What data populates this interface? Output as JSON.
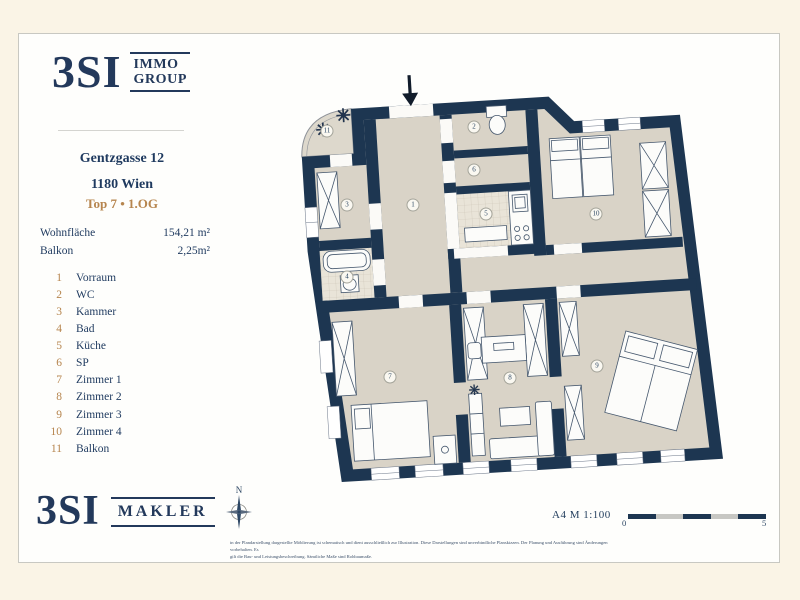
{
  "colors": {
    "brand_navy": "#23395b",
    "accent_tan": "#b6854e",
    "wall_navy": "#1d3651",
    "floor_beige": "#d9d3c7",
    "paper_cream": "#faf4e6"
  },
  "sidebar": {
    "logo_top": {
      "mark": "3SI",
      "name_line1": "IMMO",
      "name_line2": "GROUP"
    },
    "address_line1": "Gentzgasse 12",
    "address_line2": "1180 Wien",
    "unit": "Top 7 • 1.OG",
    "areas": [
      {
        "label": "Wohnfläche",
        "value": "154,21 m²"
      },
      {
        "label": "Balkon",
        "value": "2,25m²"
      }
    ],
    "rooms": [
      {
        "num": "1",
        "label": "Vorraum"
      },
      {
        "num": "2",
        "label": "WC"
      },
      {
        "num": "3",
        "label": "Kammer"
      },
      {
        "num": "4",
        "label": "Bad"
      },
      {
        "num": "5",
        "label": "Küche"
      },
      {
        "num": "6",
        "label": "SP"
      },
      {
        "num": "7",
        "label": "Zimmer 1"
      },
      {
        "num": "8",
        "label": "Zimmer 2"
      },
      {
        "num": "9",
        "label": "Zimmer 3"
      },
      {
        "num": "10",
        "label": "Zimmer 4"
      },
      {
        "num": "11",
        "label": "Balkon"
      }
    ],
    "logo_bottom": {
      "mark": "3SI",
      "name": "MAKLER"
    }
  },
  "plan_footer": {
    "north": "N",
    "scale_label": "A4 M 1:100",
    "scale_start": "0",
    "scale_end": "5"
  },
  "disclaimer": {
    "line1": "in der Plandarstellung dargestellte Möblierung ist schematisch und dient ausschließlich zur Illustration. Diese Darstellungen sind unverbindliche Planskizzen. Der Planung und Ausführung sind Änderungen vorbehalten. Es",
    "line2": "gilt die Bau- und Leistungsbeschreibung. Sämtliche Maße sind Rohbaumaße."
  }
}
